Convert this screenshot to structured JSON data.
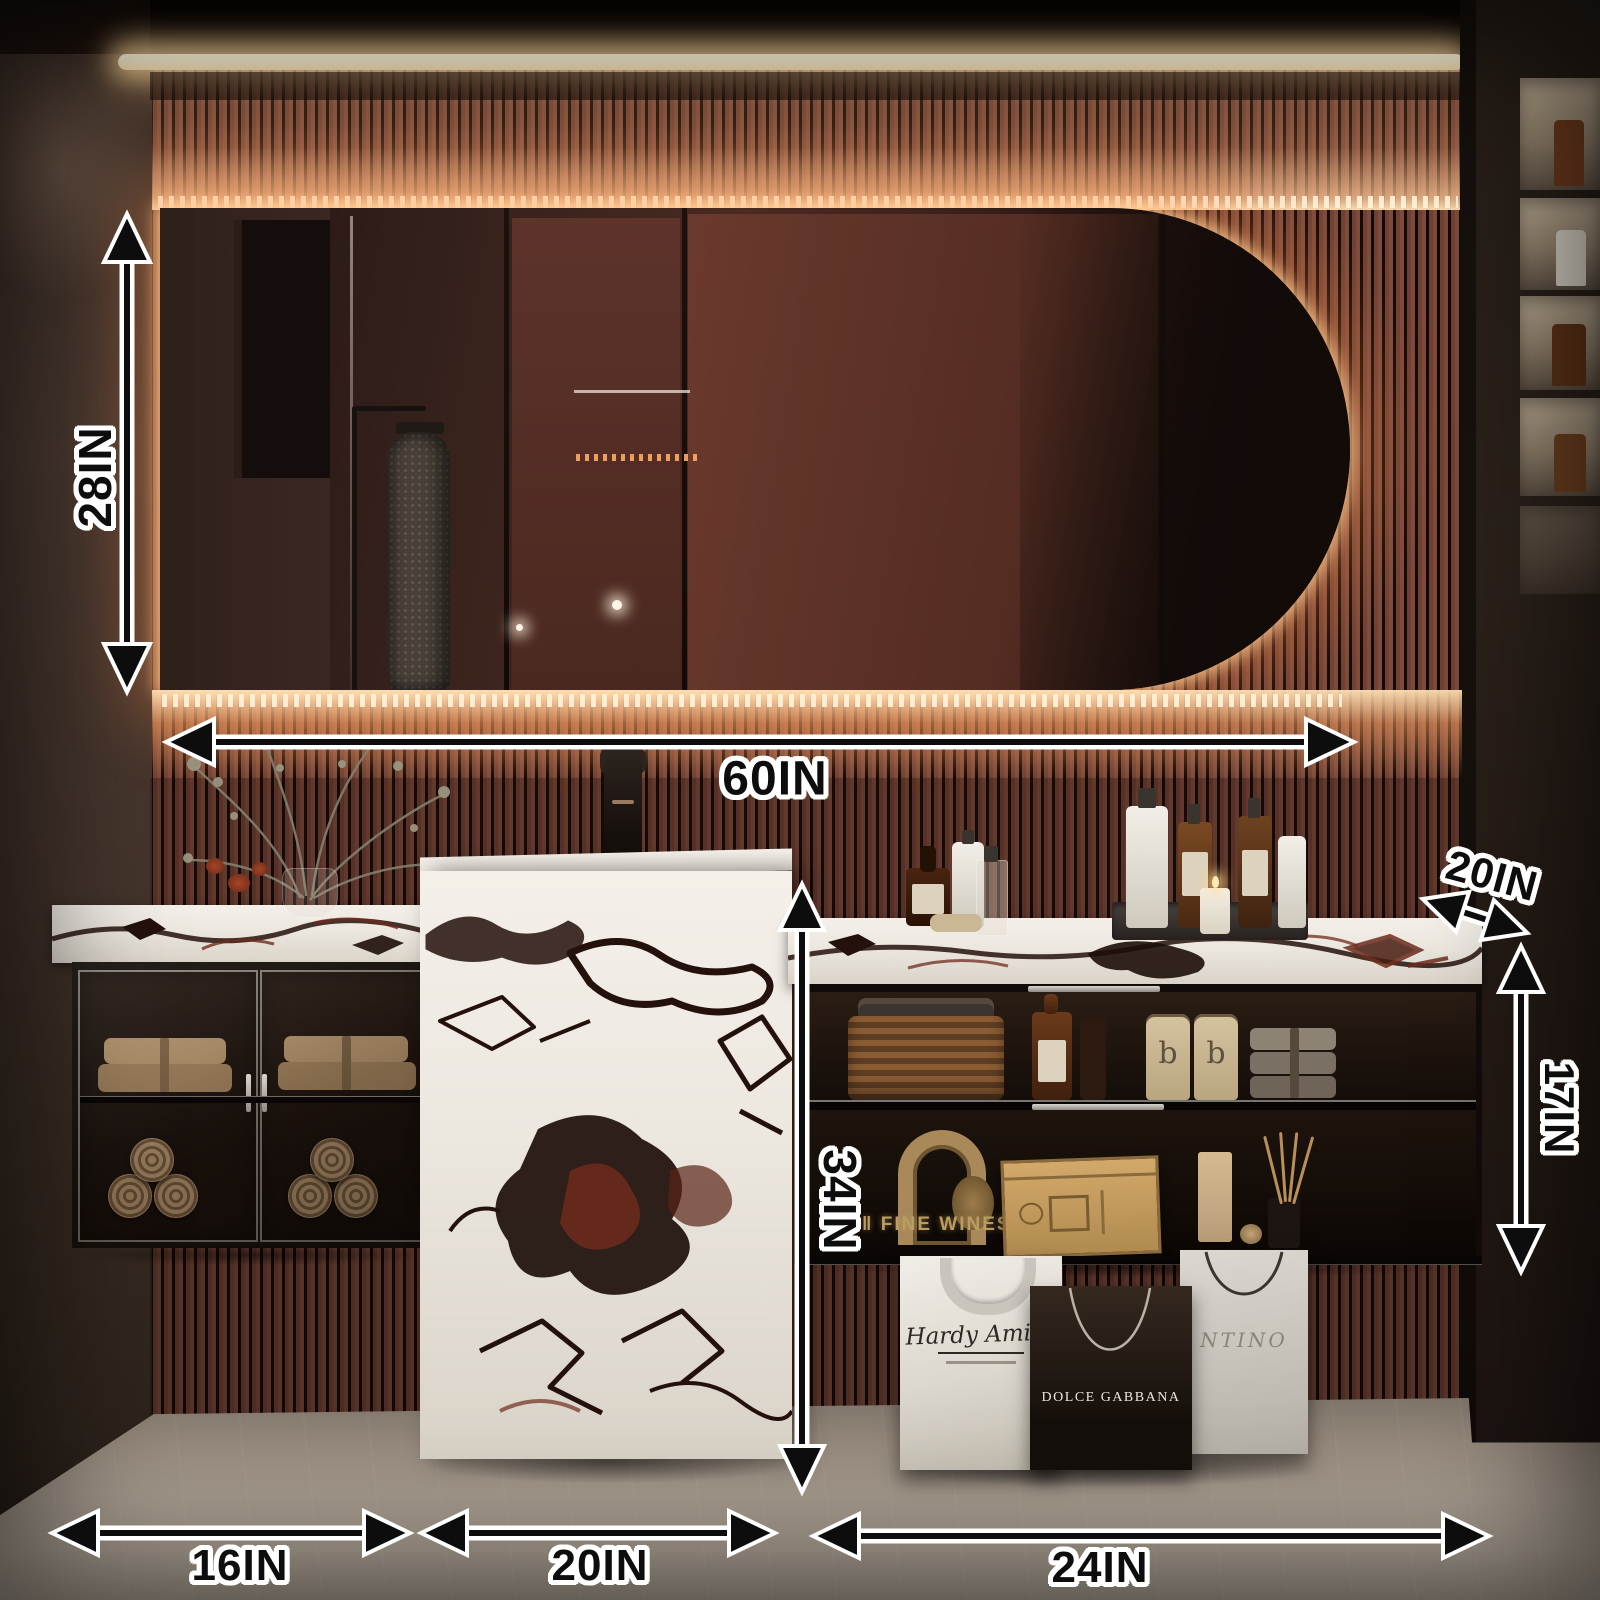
{
  "scene": {
    "description": "Backlit pill-shaped bathroom mirror above floating marble vanity set, with dimension annotations",
    "colors": {
      "led_glow": "#ffb066",
      "led_strip": "#fff4d8",
      "slat_wood": "#7d4b3c",
      "slat_gap": "#130a07",
      "marble_base": "#ece7df",
      "marble_vein_dark": "#24110b",
      "marble_vein_warm": "#6e2c1c",
      "floor": "#a89d90",
      "annotation_fill": "#0d0d0d",
      "annotation_outline": "#ffffff",
      "gold_text": "#bb9d60"
    }
  },
  "dimensions": {
    "mirror_height": "28IN",
    "mirror_width": "60IN",
    "counter_depth": "20IN",
    "right_cabinet_height": "17IN",
    "pedestal_height": "34IN",
    "left_cabinet_width": "16IN",
    "pedestal_width": "20IN",
    "right_cabinet_width": "24IN"
  },
  "decor": {
    "wine_sign": "‖ FINE WINES",
    "bottle_letter_1": "b",
    "bottle_letter_2": "b"
  },
  "bags": {
    "white_bag_text": "Hardy Amies",
    "dark_bag_text": "DOLCE GABBANA",
    "back_bag_text": "NTINO"
  }
}
